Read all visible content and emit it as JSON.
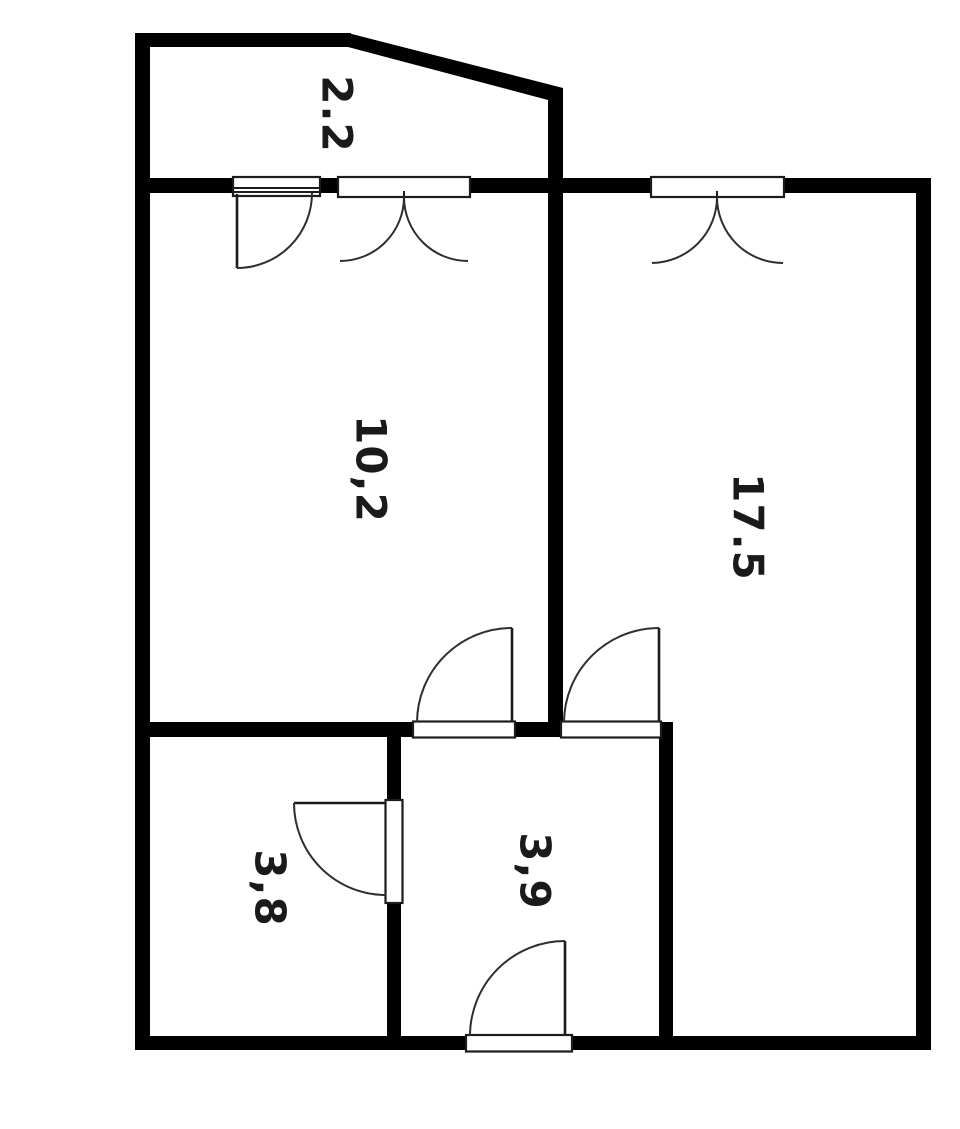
{
  "title": "One-room apartment floor plan",
  "rooms": [
    {
      "id": "balcony",
      "label": "2.2"
    },
    {
      "id": "room-left",
      "label": "10,2"
    },
    {
      "id": "room-right",
      "label": "17.5"
    },
    {
      "id": "room-bottom-left",
      "label": "3,8"
    },
    {
      "id": "room-bottom-middle",
      "label": "3,9"
    }
  ],
  "features": [
    {
      "name": "balcony-window-with-door",
      "type": "window-and-door"
    },
    {
      "name": "balcony-double-casement-window",
      "type": "double-window"
    },
    {
      "name": "top-double-casement-window",
      "type": "double-window"
    },
    {
      "name": "door-to-left-room",
      "type": "door"
    },
    {
      "name": "door-to-right-room",
      "type": "door"
    },
    {
      "name": "door-between-bottom-rooms",
      "type": "door"
    },
    {
      "name": "entrance-door-bottom",
      "type": "door"
    }
  ],
  "colors": {
    "walls": "#000000",
    "background": "#ffffff",
    "labels": "#1a1a1a"
  }
}
